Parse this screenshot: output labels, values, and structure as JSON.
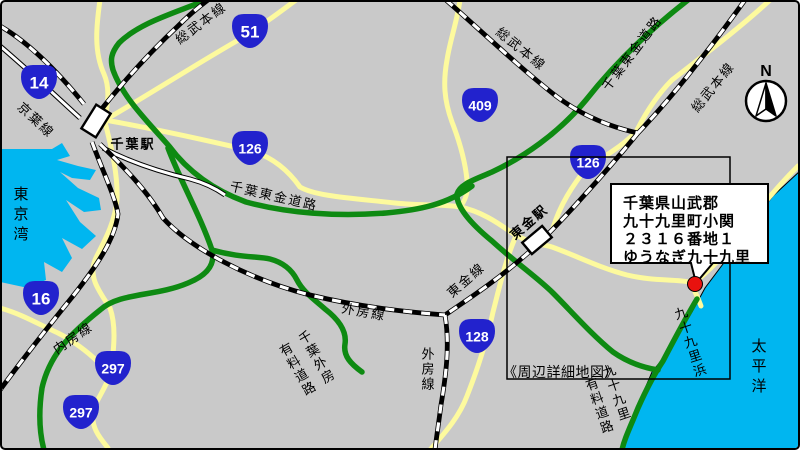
{
  "labels": {
    "sobu_main": "総武本線",
    "keiyo": "京葉線",
    "uchibo": "内房線",
    "sotobo": "外房線",
    "togane_line": "東金線",
    "chiba_station": "千葉駅",
    "togane_station": "東金駅",
    "chiba_togane_road": "千葉東金道路",
    "chiba_sotobo_toll_1": "千葉外房",
    "chiba_sotobo_toll_2": "有料道路",
    "kujukuri_toll_1": "九十九里",
    "kujukuri_toll_2": "有料道路",
    "kujukuri_beach": "九十九里浜",
    "tokyo_bay": "東京湾",
    "pacific_ocean": "太平洋",
    "detail_map_note": "《周辺詳細地図》",
    "compass_north": "N"
  },
  "routes": [
    "14",
    "51",
    "126",
    "409",
    "126",
    "16",
    "297",
    "297",
    "128"
  ],
  "address": {
    "line1": "千葉県山武郡",
    "line2": "九十九里町小関",
    "line3": "２３１６番地１",
    "line4": "ゆうなぎ九十九里"
  },
  "colors": {
    "land": "#c9c9c9",
    "water": "#00b6f0",
    "road_yellow": "#fdfa9e",
    "road_green": "#0e8a12",
    "shield_blue": "#2222cd",
    "marker_red": "#e8120e"
  }
}
